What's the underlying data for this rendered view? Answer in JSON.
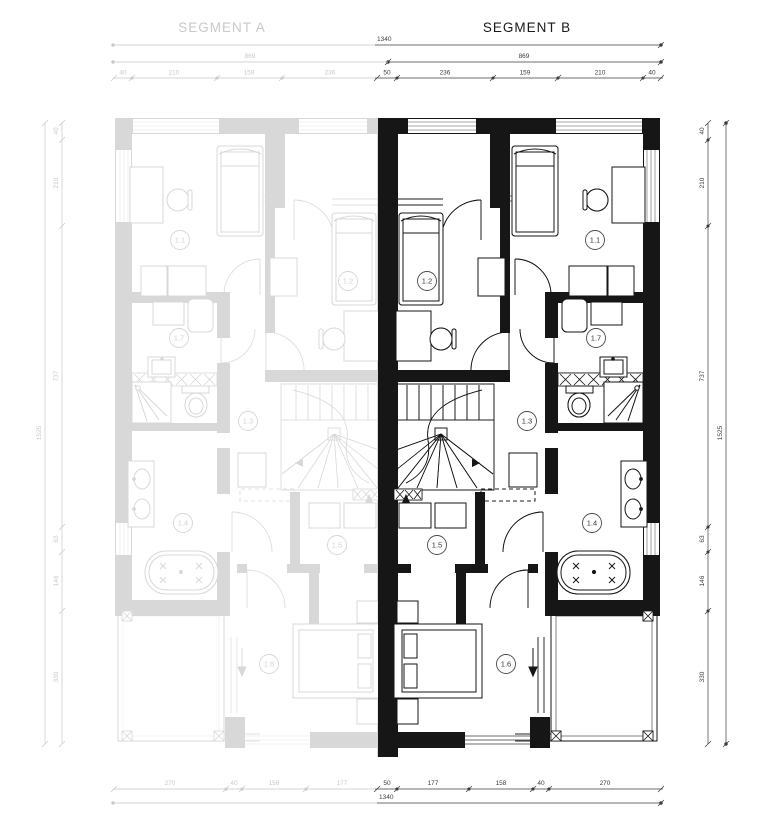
{
  "title": {
    "segment_a": "SEGMENT A",
    "segment_b": "SEGMENT B"
  },
  "dims": {
    "top_total": "1340",
    "top_b_width": "869",
    "top_a_width": "869",
    "top_b": [
      "50",
      "236",
      "159",
      "210",
      "40"
    ],
    "top_a": [
      "40",
      "210",
      "159",
      "236"
    ],
    "bottom_total": "1340",
    "bottom_b": [
      "50",
      "177",
      "158",
      "40",
      "270"
    ],
    "bottom_a": [
      "270",
      "40",
      "158",
      "177"
    ],
    "right": [
      "40",
      "210",
      "737",
      "63",
      "146",
      "330"
    ],
    "right_total": "1525",
    "left": [
      "40",
      "210",
      "737",
      "63",
      "146",
      "330"
    ],
    "left_total": "1525"
  },
  "rooms": [
    {
      "label": "1.1"
    },
    {
      "label": "1.2"
    },
    {
      "label": "1.3"
    },
    {
      "label": "1.4"
    },
    {
      "label": "1.5"
    },
    {
      "label": "1.6"
    },
    {
      "label": "1.7"
    }
  ],
  "colors": {
    "active": "#161616",
    "ghost": "#d8d8d8",
    "dim": "#3c3c3c",
    "dim_ghost": "#c9c9c9"
  }
}
